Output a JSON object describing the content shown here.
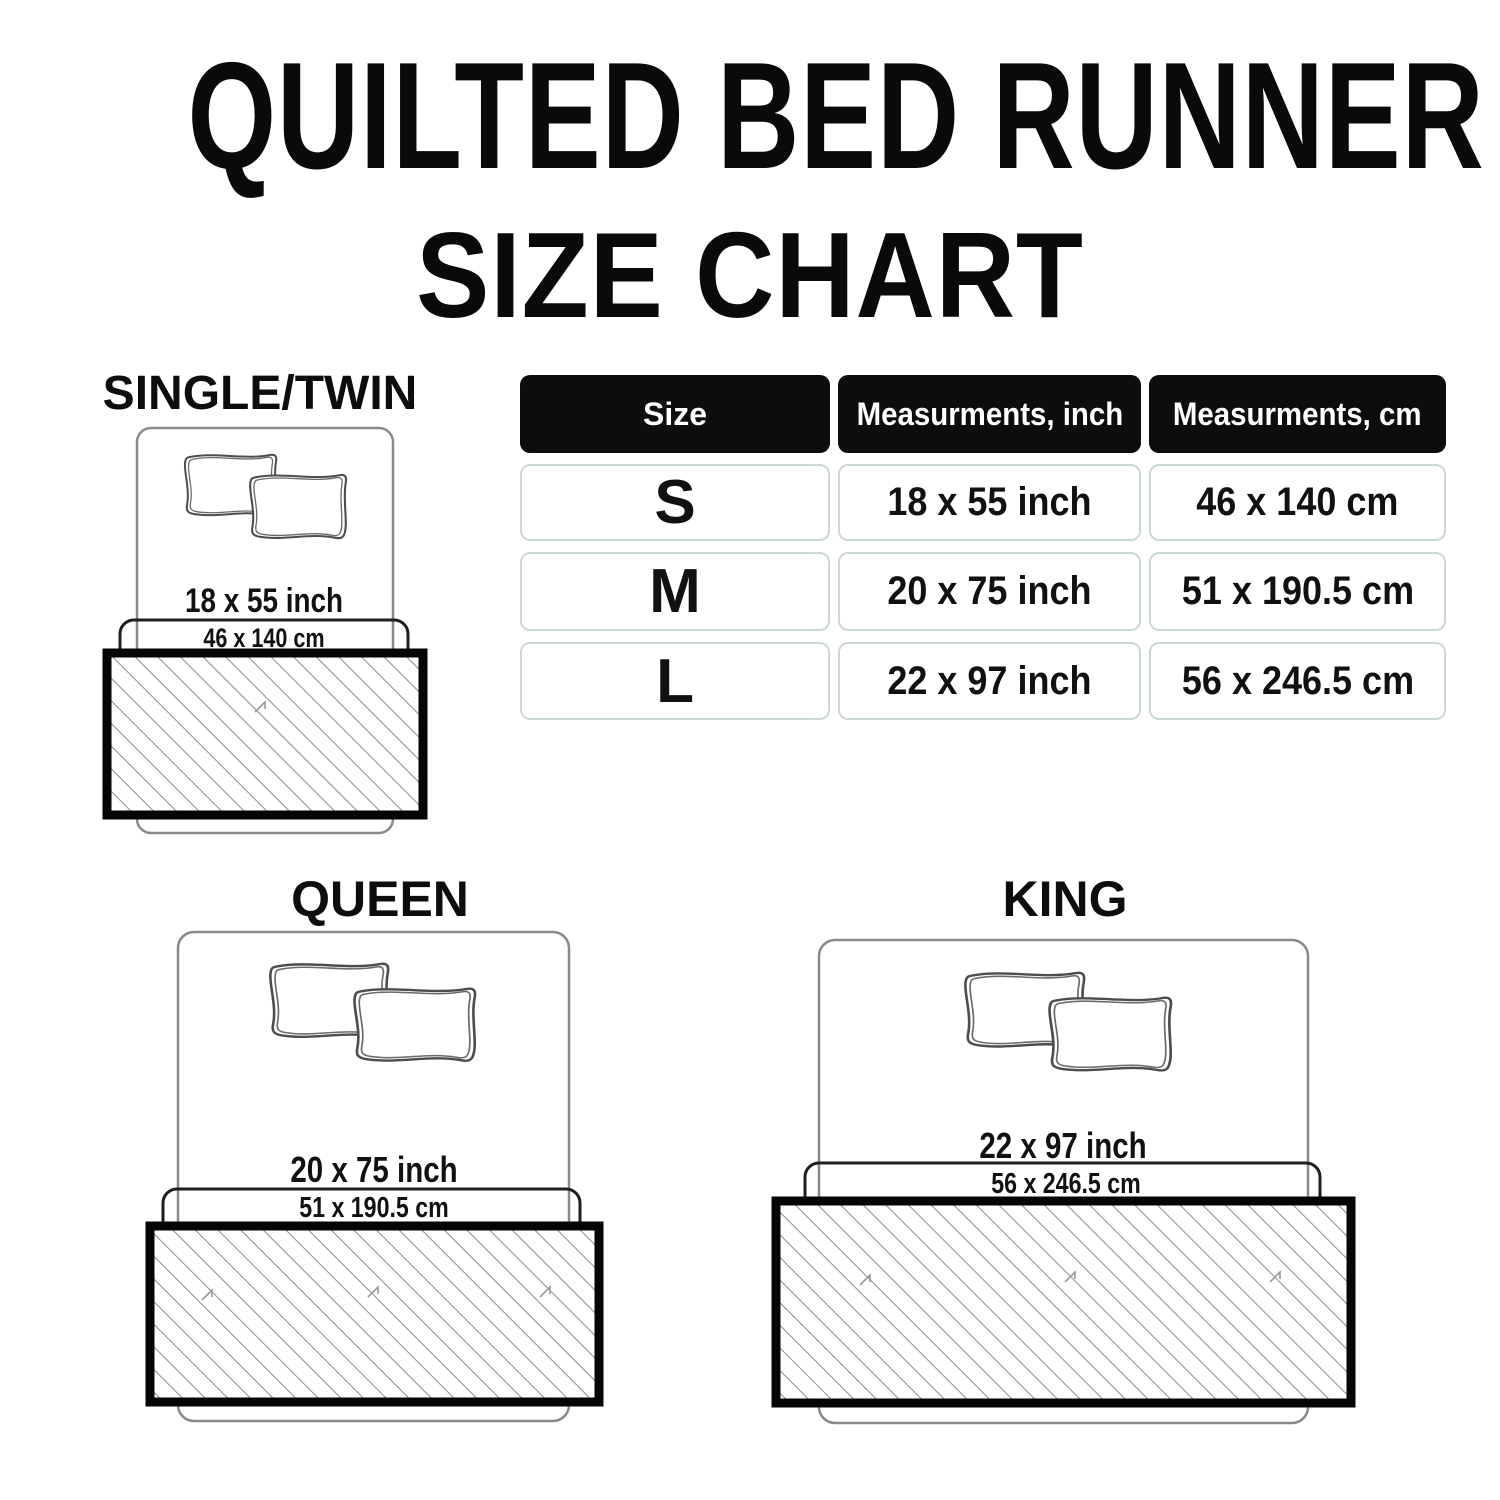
{
  "title": {
    "line1": "QUILTED BED RUNNER",
    "line2": "SIZE CHART"
  },
  "table": {
    "headers": [
      "Size",
      "Measurments, inch",
      "Measurments, cm"
    ],
    "rows": [
      {
        "size": "S",
        "inch": "18 x 55 inch",
        "cm": "46 x 140 cm"
      },
      {
        "size": "M",
        "inch": "20 x 75 inch",
        "cm": "51 x 190.5 cm"
      },
      {
        "size": "L",
        "inch": "22 x 97 inch",
        "cm": "56 x 246.5 cm"
      }
    ]
  },
  "diagrams": [
    {
      "name": "SINGLE/TWIN",
      "inch": "18 x 55 inch",
      "cm": "46 x 140 cm"
    },
    {
      "name": "QUEEN",
      "inch": "20 x 75 inch",
      "cm": "51 x 190.5 cm"
    },
    {
      "name": "KING",
      "inch": "22 x 97 inch",
      "cm": "56 x 246.5 cm"
    }
  ],
  "chart_data": {
    "type": "table",
    "title": "QUILTED BED RUNNER SIZE CHART",
    "columns": [
      "Size",
      "Measurments, inch",
      "Measurments, cm"
    ],
    "rows": [
      [
        "S",
        "18 x 55 inch",
        "46 x 140 cm"
      ],
      [
        "M",
        "20 x 75 inch",
        "51 x 190.5 cm"
      ],
      [
        "L",
        "22 x 97 inch",
        "56 x 246.5 cm"
      ]
    ]
  },
  "colors": {
    "text": "#0d0d0d",
    "table_header_bg": "#0d0d0d",
    "table_header_text": "#ffffff",
    "cell_border": "#ccd8d8",
    "bed_outline": "#8a8a8a",
    "runner_border": "#050505",
    "hatch_line": "#8c8c8c"
  }
}
